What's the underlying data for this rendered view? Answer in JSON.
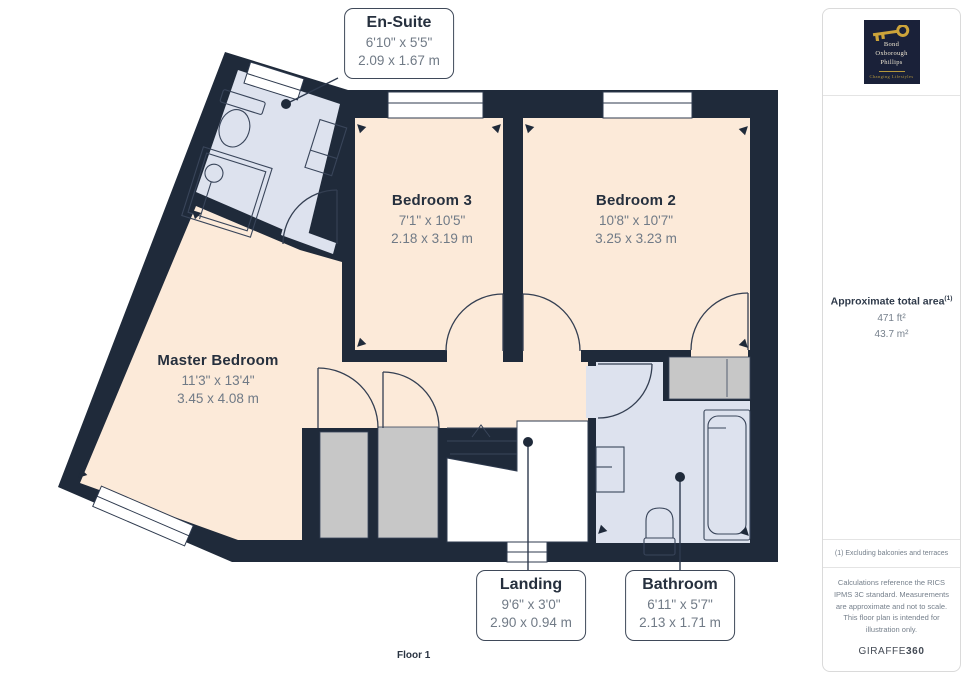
{
  "floor_label": "Floor 1",
  "rooms": {
    "ensuite": {
      "name": "En-Suite",
      "imperial": "6'10\" x 5'5\"",
      "metric": "2.09 x 1.67 m"
    },
    "bedroom3": {
      "name": "Bedroom 3",
      "imperial": "7'1\" x 10'5\"",
      "metric": "2.18 x 3.19 m"
    },
    "bedroom2": {
      "name": "Bedroom 2",
      "imperial": "10'8\" x 10'7\"",
      "metric": "3.25 x 3.23 m"
    },
    "master": {
      "name": "Master Bedroom",
      "imperial": "11'3\" x 13'4\"",
      "metric": "3.45 x 4.08 m"
    },
    "landing": {
      "name": "Landing",
      "imperial": "9'6\" x 3'0\"",
      "metric": "2.90 x 0.94 m"
    },
    "bathroom": {
      "name": "Bathroom",
      "imperial": "6'11\" x 5'7\"",
      "metric": "2.13 x 1.71 m"
    }
  },
  "sidebar": {
    "logo": {
      "line1": "Bond",
      "line2": "Oxborough",
      "line3": "Phillips",
      "tagline": "Changing Lifestyles",
      "key_icon": "gold-key"
    },
    "area_title": "Approximate total area",
    "area_sup": "(1)",
    "area_ft": "471 ft²",
    "area_m": "43.7 m²",
    "note": "(1) Excluding balconies and terraces",
    "disclaimer": "Calculations reference the RICS IPMS 3C standard. Measurements are approximate and not to scale. This floor plan is intended for illustration only.",
    "brand": "GIRAFFE",
    "brand_bold": "360"
  },
  "colors": {
    "wall": "#1f2a3a",
    "floor": "#fcead9",
    "wet_room": "#dde2ee",
    "storage": "#c7c7c7",
    "line": "#39455a",
    "logo_navy": "#1a2139",
    "logo_gold": "#cda43a",
    "dim_text": "#707a86",
    "title_text": "#26303e"
  }
}
